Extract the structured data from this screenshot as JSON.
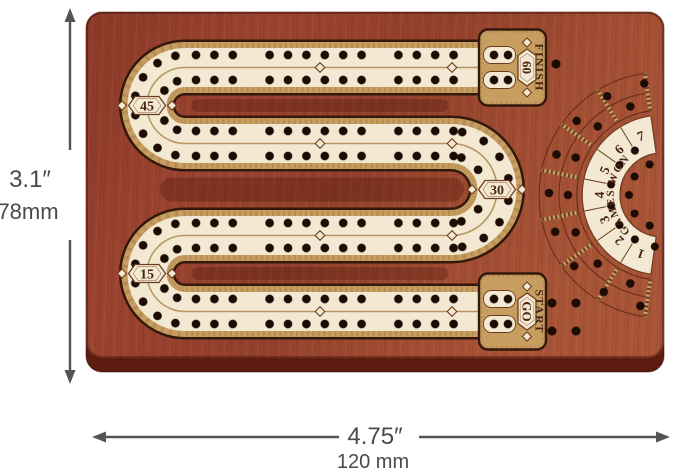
{
  "colors": {
    "wood": "#9a4430",
    "wood_edge": "#5c1d10",
    "cream": "#f3e9d2",
    "gold": "#c79e60",
    "gold_fleck": "#8a6336",
    "gold_line": "#b08c52",
    "outline": "#33180b",
    "engrave": "#6e3d1f",
    "hole": "#1d0c04",
    "text": "#4a2511",
    "dim": "#545456"
  },
  "dimensions": {
    "height_in": "3.1″",
    "height_mm": "78mm",
    "width_in": "4.75″",
    "width_mm": "120 mm"
  },
  "track": {
    "rows": [
      {
        "y": 67.5,
        "badges": [
          {
            "x": 255,
            "label": "50"
          },
          {
            "x": 385,
            "label": "55"
          }
        ]
      },
      {
        "y": 143.5,
        "badges": [
          {
            "x": 385,
            "label": "35"
          },
          {
            "x": 257,
            "label": "40"
          }
        ]
      },
      {
        "y": 235.5,
        "badges": [
          {
            "x": 257,
            "label": "20"
          },
          {
            "x": 385,
            "label": "25"
          }
        ]
      },
      {
        "y": 311.5,
        "badges": [
          {
            "x": 385,
            "label": "5"
          },
          {
            "x": 257,
            "label": "10"
          }
        ]
      }
    ],
    "bends": [
      {
        "cx": 185,
        "cy": 105.5,
        "r": 38,
        "dir": "left",
        "label": "45"
      },
      {
        "cx": 451,
        "cy": 189.5,
        "r": 46,
        "dir": "right",
        "label": "30"
      },
      {
        "cx": 185,
        "cy": 273.5,
        "r": 38,
        "dir": "left",
        "label": "15"
      }
    ],
    "end_blocks": [
      {
        "x": 479,
        "y": 67.5,
        "label": "FINISH",
        "badge": "60"
      },
      {
        "x": 479,
        "y": 311.5,
        "label": "START",
        "badge": "GO"
      }
    ],
    "extra_holes": [
      [
        556,
        64
      ],
      [
        552,
        303
      ],
      [
        576,
        303
      ],
      [
        552,
        331
      ],
      [
        576,
        331
      ]
    ]
  },
  "fan": {
    "cx": 662,
    "cy": 195,
    "title": "GAMES WON",
    "numbers": [
      "1",
      "2",
      "3",
      "4",
      "5",
      "6",
      "7"
    ]
  }
}
